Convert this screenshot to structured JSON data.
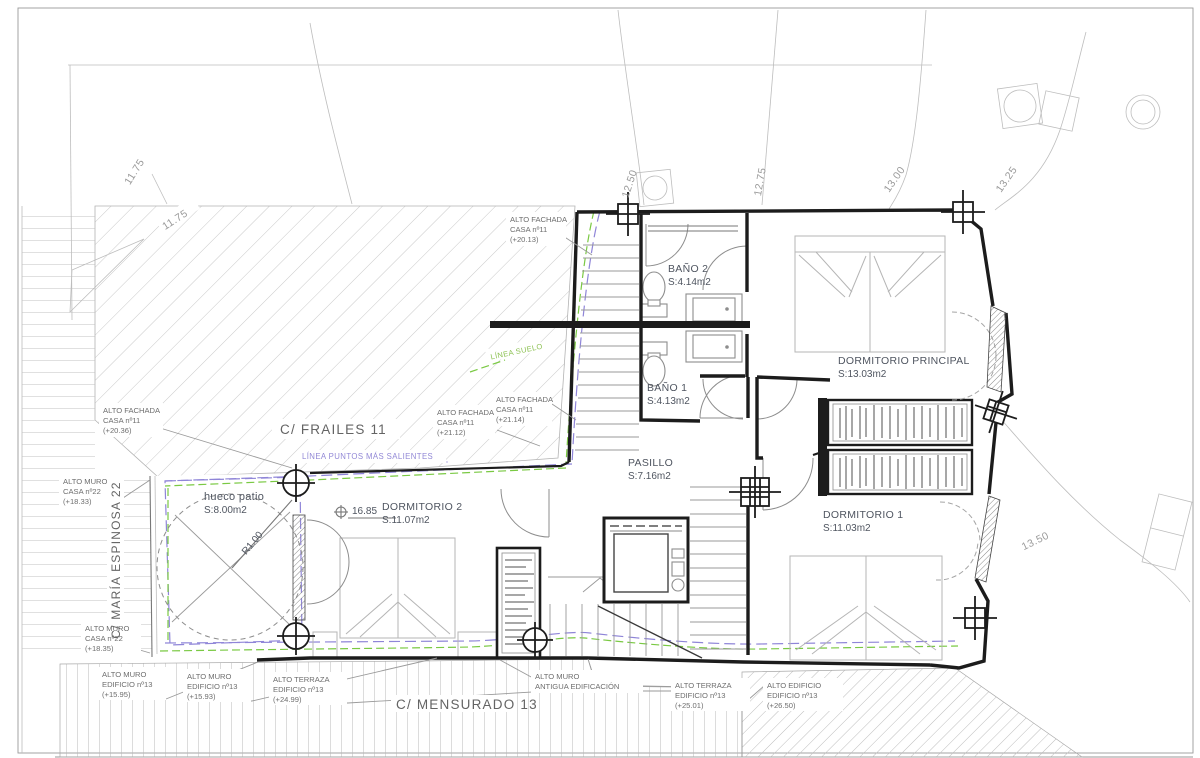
{
  "drawing": {
    "streets": {
      "frailes": "C/ FRAILES 11",
      "maria_espinosa": "C/ MARÍA ESPINOSA 22",
      "mensurado": "C/ MENSURADO 13"
    },
    "rooms": {
      "dormitorio_principal": {
        "name": "DORMITORIO PRINCIPAL",
        "area": "S:13.03m2"
      },
      "dormitorio_1": {
        "name": "DORMITORIO 1",
        "area": "S:11.03m2"
      },
      "dormitorio_2": {
        "name": "DORMITORIO 2",
        "area": "S:11.07m2"
      },
      "banio_1": {
        "name": "BAÑO 1",
        "area": "S:4.13m2"
      },
      "banio_2": {
        "name": "BAÑO 2",
        "area": "S:4.14m2"
      },
      "pasillo": {
        "name": "PASILLO",
        "area": "S:7.16m2"
      },
      "hueco_patio": {
        "name": "hueco patio",
        "area": "S:8.00m2"
      }
    },
    "levels": {
      "floor_level": "16.85",
      "patio_radius": "R1.00"
    },
    "contours": {
      "c1175a": "11.75",
      "c1175b": "11.75",
      "c1250": "12.50",
      "c1275": "12.75",
      "c1300": "13.00",
      "c1325": "13.25",
      "c1350": "13.50"
    },
    "reference_lines": {
      "linea_suelo": "LÍNEA SUELO",
      "linea_puntos": "LÍNEA PUNTOS MÁS SALIENTES"
    },
    "annotations": {
      "fachada_2013": {
        "l1": "ALTO FACHADA",
        "l2": "CASA nº11",
        "l3": "(+20.13)"
      },
      "fachada_2036": {
        "l1": "ALTO FACHADA",
        "l2": "CASA nº11",
        "l3": "(+20.36)"
      },
      "fachada_2112": {
        "l1": "ALTO FACHADA",
        "l2": "CASA nº11",
        "l3": "(+21.12)"
      },
      "fachada_2114": {
        "l1": "ALTO FACHADA",
        "l2": "CASA nº11",
        "l3": "(+21.14)"
      },
      "muro_1833": {
        "l1": "ALTO MURO",
        "l2": "CASA nº22",
        "l3": "(+18.33)"
      },
      "muro_1835": {
        "l1": "ALTO MURO",
        "l2": "CASA nº22",
        "l3": "(+18.35)"
      },
      "muro_1595": {
        "l1": "ALTO MURO",
        "l2": "EDIFICIO nº13",
        "l3": "(+15.95)"
      },
      "muro_1593": {
        "l1": "ALTO MURO",
        "l2": "EDIFICIO nº13",
        "l3": "(+15.93)"
      },
      "terraza_2499": {
        "l1": "ALTO TERRAZA",
        "l2": "EDIFICIO nº13",
        "l3": "(+24.99)"
      },
      "terraza_2501": {
        "l1": "ALTO TERRAZA",
        "l2": "EDIFICIO nº13",
        "l3": "(+25.01)"
      },
      "edificio_2650": {
        "l1": "ALTO EDIFICIO",
        "l2": "EDIFICIO nº13",
        "l3": "(+26.50)"
      },
      "muro_antigua": {
        "l1": "ALTO MURO",
        "l2": "ANTIGUA EDIFICACIÓN"
      }
    },
    "colors": {
      "wall": "#1c1c1c",
      "thin_line": "#9a9a9a",
      "hatch": "#c9c9c9",
      "room_text": "#4f5560",
      "green_dash": "#7ac943",
      "purple_dash": "#8f85d8"
    }
  }
}
